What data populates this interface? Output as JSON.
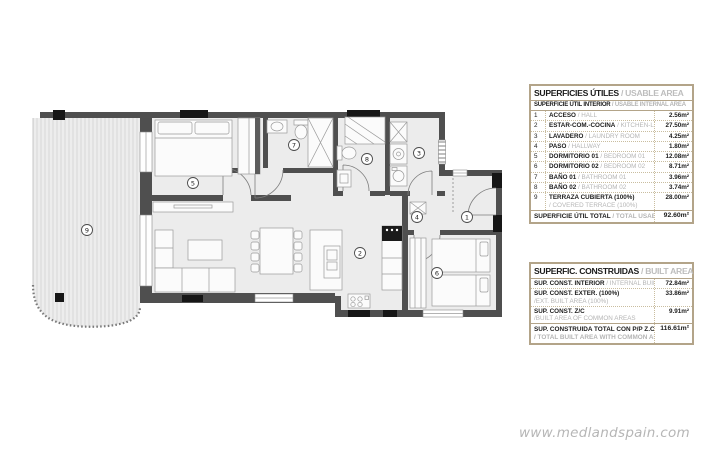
{
  "plan": {
    "labels": [
      {
        "n": "1"
      },
      {
        "n": "2"
      },
      {
        "n": "3"
      },
      {
        "n": "4"
      },
      {
        "n": "5"
      },
      {
        "n": "6"
      },
      {
        "n": "7"
      },
      {
        "n": "8"
      },
      {
        "n": "9"
      }
    ]
  },
  "tables": {
    "usable": {
      "title_es": "SUPERFICIES ÚTILES",
      "title_en": " / USABLE AREA",
      "sub_es": "SUPERFICIE ÚTIL INTERIOR",
      "sub_en": " / USABLE INTERNAL AREA",
      "rows": [
        {
          "num": "1",
          "es": "ACCESO",
          "en": " / HALL",
          "value": "2.56m²"
        },
        {
          "num": "2",
          "es": "ESTAR-COM.-COCINA",
          "en": " / KITCHEN-LIVING",
          "value": "27.50m²"
        },
        {
          "num": "3",
          "es": "LAVADERO",
          "en": " / LAUNDRY ROOM",
          "value": "4.25m²"
        },
        {
          "num": "4",
          "es": "PASO",
          "en": " / HALLWAY",
          "value": "1.80m²"
        },
        {
          "num": "5",
          "es": "DORMITORIO 01",
          "en": " / BEDROOM 01",
          "value": "12.08m²"
        },
        {
          "num": "6",
          "es": "DORMITORIO 02",
          "en": " / BEDROOM 02",
          "value": "8.71m²"
        },
        {
          "num": "7",
          "es": "BAÑO 01",
          "en": " / BATHROOM 01",
          "value": "3.96m²"
        },
        {
          "num": "8",
          "es": "BAÑO 02",
          "en": " / BATHROOM 02",
          "value": "3.74m²"
        },
        {
          "num": "9",
          "es": "TERRAZA CUBIERTA (100%)",
          "en": "/ COVERED TERRACE (100%)",
          "value": "28.00m²"
        }
      ],
      "total_es": "SUPERFICIE ÚTIL TOTAL",
      "total_en": " / TOTAL USABLE AREA",
      "total_value": "92.60m²"
    },
    "built": {
      "title_es": "SUPERFIC. CONSTRUIDAS",
      "title_en": " / BUILT AREA",
      "rows": [
        {
          "es": "SUP. CONST. INTERIOR",
          "en": " / INTERNAL BUILT AREA",
          "value": "72.84m²"
        },
        {
          "es": "SUP. CONST. EXTER. (100%)",
          "en": "/EXT. BUILT AREA (100%)",
          "value": "33.86m²"
        },
        {
          "es": "SUP. CONST. Z/C",
          "en": "/BUILT AREA OF COMMON AREAS",
          "value": "9.91m²"
        }
      ],
      "total_es": "SUP. CONSTRUIDA TOTAL CON P/P Z.C",
      "total_en": "/ TOTAL BUILT AREA WITH COMMON AREAS",
      "total_value": "116.61m²"
    }
  },
  "watermark": "www.medlandspain.com",
  "colors": {
    "table_border": "#b3a489",
    "wall": "#4f4f4f",
    "muted_text": "#b5b5b5",
    "floor": "#ececec"
  }
}
